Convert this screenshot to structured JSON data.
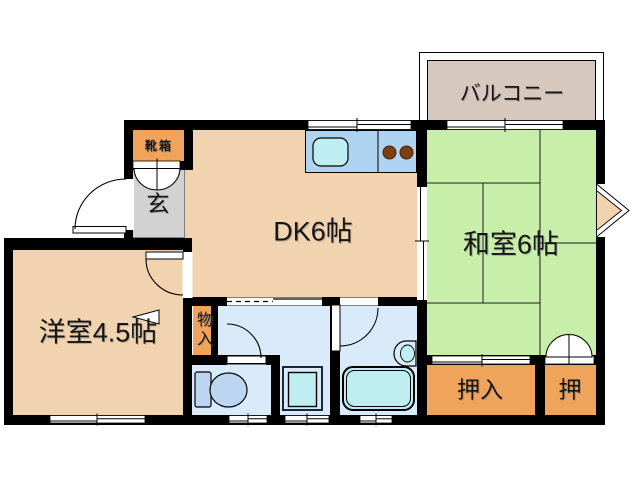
{
  "rooms": {
    "balcony": "バルコニー",
    "dining_kitchen": "DK6帖",
    "japanese_room": "和室6帖",
    "western_room": "洋室4.5帖",
    "entrance": "玄",
    "shoe_box": "靴箱",
    "storage": "物入",
    "closet_large": "押入",
    "closet_small": "押"
  },
  "colors": {
    "wall": "#000000",
    "wood_floor": "#f2d3af",
    "tatami_green": "#c8efa9",
    "balcony_fill": "#d6c8bd",
    "closet_orange": "#f0a35b",
    "entrance_gray": "#d2d2d2",
    "counter_blue": "#aed4f2",
    "water_room_blue": "#d9eafa",
    "fixture_blue": "#bcd6f2",
    "appliance_cyan": "#bfeef2",
    "burner_brown": "#7e3f10"
  }
}
